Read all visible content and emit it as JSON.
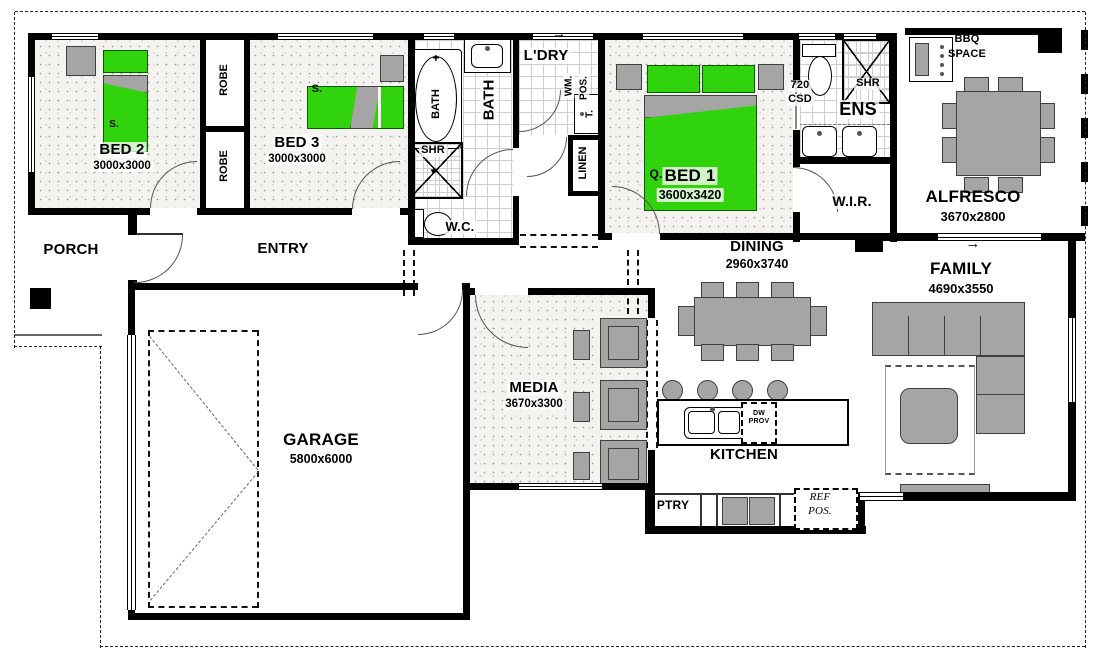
{
  "rooms": {
    "bed1": {
      "label": "BED 1",
      "dims": "3600x3420"
    },
    "bed2": {
      "label": "BED 2",
      "dims": "3000x3000"
    },
    "bed3": {
      "label": "BED 3",
      "dims": "3000x3000"
    },
    "bath": {
      "label": "BATH"
    },
    "wc": {
      "label": "W.C."
    },
    "ldry": {
      "label": "L'DRY"
    },
    "linen": {
      "label": "LINEN"
    },
    "ens": {
      "label": "ENS"
    },
    "wir": {
      "label": "W.I.R."
    },
    "porch": {
      "label": "PORCH"
    },
    "entry": {
      "label": "ENTRY"
    },
    "garage": {
      "label": "GARAGE",
      "dims": "5800x6000"
    },
    "media": {
      "label": "MEDIA",
      "dims": "3670x3300"
    },
    "dining": {
      "label": "DINING",
      "dims": "2960x3740"
    },
    "kitchen": {
      "label": "KITCHEN"
    },
    "family": {
      "label": "FAMILY",
      "dims": "4690x3550"
    },
    "alfresco": {
      "label": "ALFRESCO",
      "dims": "3670x2800"
    }
  },
  "fixtures": {
    "robe_top": "ROBE",
    "robe_bottom": "ROBE",
    "tub_label": "BATH",
    "tub_plus": "+",
    "shower_bath": "SHR",
    "shower_ens": "SHR",
    "wm_line1": "WM.",
    "wm_line2": "POS.",
    "trough": "T.",
    "csd_line1": "720",
    "csd_line2": "CSD",
    "bbq_line1": "BBQ",
    "bbq_line2": "SPACE",
    "pantry": "PTRY",
    "dw_line1": "DW",
    "dw_line2": "PROV",
    "ref_line1": "REF",
    "ref_line2": "POS.",
    "bed1_type": "Q.",
    "bed2_type": "S.",
    "bed3_type": "S."
  },
  "icons": {
    "arrow_right": "→",
    "shower_head": "▼"
  },
  "colors": {
    "bed_green": "#31d30c",
    "furniture_gray": "#a5a5a5",
    "wall_black": "#000000"
  }
}
